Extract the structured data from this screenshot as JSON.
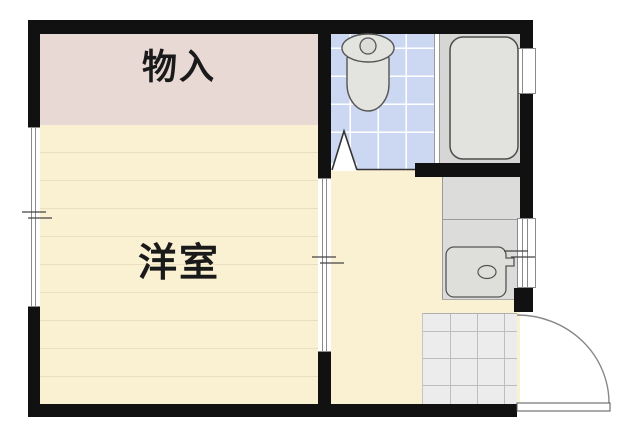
{
  "plan": {
    "type": "apartment-floor-plan",
    "rooms": {
      "storage": {
        "label": "物入",
        "floor_color": "#e8d9d4"
      },
      "western_room": {
        "label": "洋室",
        "floor_color": "#faf0d2",
        "plank_line_color": "#ebdfbf"
      },
      "toilet_room": {
        "label": "",
        "floor_color": "#ccd8f2",
        "tile_grid_color": "#ffffff"
      },
      "bathroom": {
        "label": "",
        "floor_color": "#d6d6d4"
      },
      "vanity_area": {
        "label": "",
        "counter_color": "#dcdcda"
      },
      "entrance": {
        "label": "",
        "tile_color": "#ececec",
        "tile_grid_color": "#bdbdbd"
      }
    },
    "fixtures": [
      {
        "name": "toilet-icon",
        "fill": "#e3e3df",
        "stroke": "#555555"
      },
      {
        "name": "bathtub-icon",
        "fill": "#e2e2de",
        "stroke": "#4d4d4d"
      },
      {
        "name": "washbasin-icon",
        "fill": "#dededa",
        "stroke": "#555555"
      },
      {
        "name": "folding-door-icon",
        "stroke": "#333333"
      },
      {
        "name": "entry-door-icon",
        "stroke": "#888888"
      },
      {
        "name": "sliding-window-icon",
        "stroke": "#8a8a8a"
      }
    ],
    "colors": {
      "wall": "#111111",
      "background": "#ffffff"
    }
  }
}
